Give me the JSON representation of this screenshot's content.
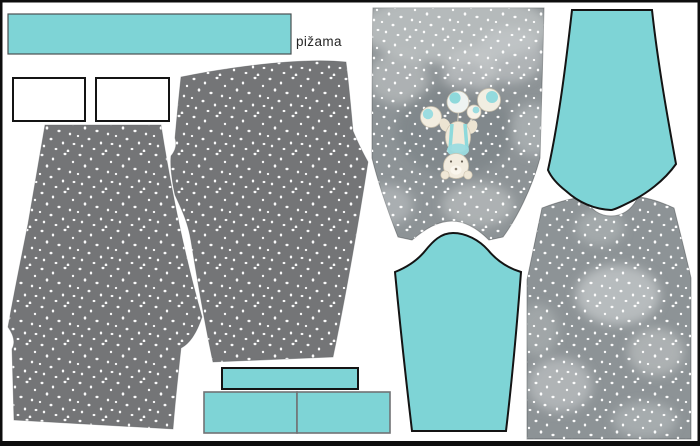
{
  "panel": {
    "label": "pižama"
  },
  "colors": {
    "background": "#ffffff",
    "frame_border": "#0e0e0e",
    "turquoise": "#7ed4d6",
    "fabric_gray": "#747577",
    "bodice_gray": "#8d9396",
    "cloud_light": "#c6cacb",
    "dot_white": "#ffffff",
    "outline_dark": "#141414",
    "cuff_border_gray": "#717274"
  },
  "pieces": [
    {
      "id": "neckband-strip",
      "fabric": "turquoise"
    },
    {
      "id": "pocket-rectangle-1",
      "fabric": "white"
    },
    {
      "id": "pocket-rectangle-2",
      "fabric": "white"
    },
    {
      "id": "pant-leg-left",
      "fabric": "gray-dots"
    },
    {
      "id": "pant-leg-right",
      "fabric": "gray-dots"
    },
    {
      "id": "front-bodice",
      "fabric": "gray-dots-clouds-teddy"
    },
    {
      "id": "back-bodice",
      "fabric": "gray-dots-clouds"
    },
    {
      "id": "sleeve-top-right",
      "fabric": "turquoise"
    },
    {
      "id": "sleeve-bottom",
      "fabric": "turquoise"
    },
    {
      "id": "cuff-bar",
      "fabric": "turquoise"
    },
    {
      "id": "cuff-left",
      "fabric": "turquoise"
    },
    {
      "id": "cuff-right",
      "fabric": "turquoise"
    }
  ]
}
